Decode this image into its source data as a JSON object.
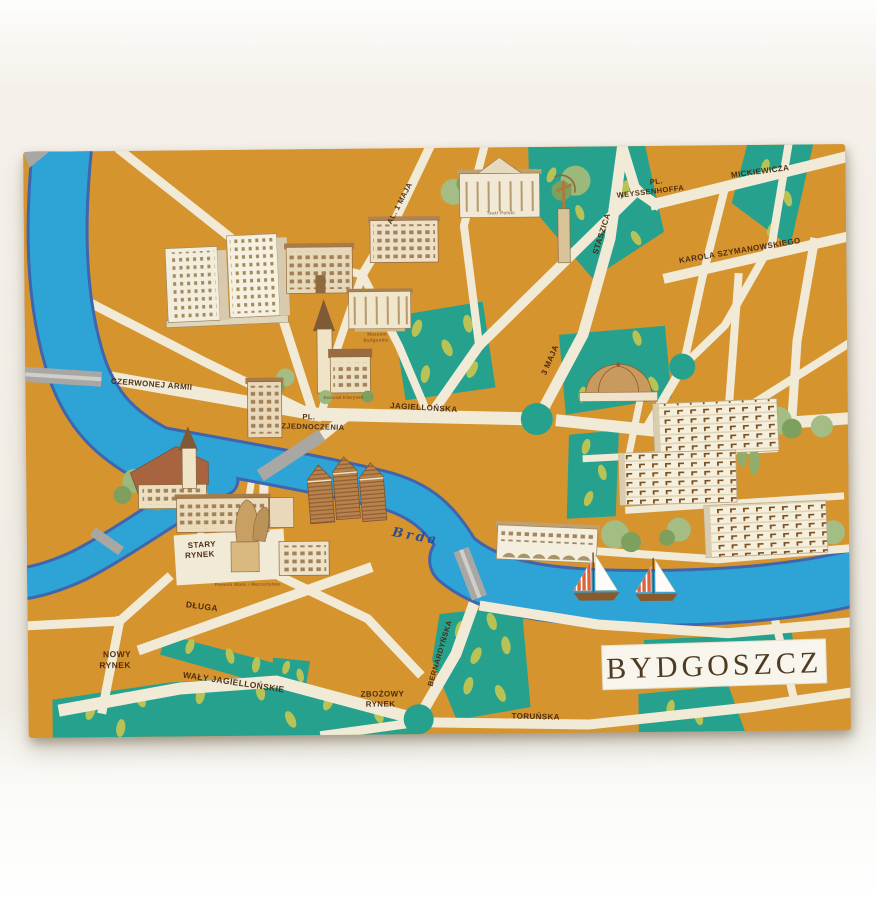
{
  "postcard": {
    "title": "BYDGOSZCZ",
    "river_label": "Brda",
    "labels": {
      "al_1_maja": "AL. 1 MAJA",
      "pl_weyssenhoffa_line1": "PL.",
      "pl_weyssenhoffa_line2": "WEYSSENHOFFA",
      "mickiewicza": "MICKIEWICZA",
      "karola_szymanowskiego": "KAROLA SZYMANOWSKIEGO",
      "staszica": "STASZICA",
      "trzeciego_maja": "3 MAJA",
      "czerwonej_armii": "CZERWONEJ ARMII",
      "jagiellonska": "JAGIELLOŃSKA",
      "pl_zjednoczenia_line1": "PL.",
      "pl_zjednoczenia_line2": "ZJEDNOCZENIA",
      "stary_rynek_line1": "STARY",
      "stary_rynek_line2": "RYNEK",
      "dluga": "DŁUGA",
      "nowy_rynek_line1": "NOWY",
      "nowy_rynek_line2": "RYNEK",
      "waly_jagiellonskie": "WAŁY JAGIELLOŃSKIE",
      "zbozowy_rynek_line1": "ZBOŻOWY",
      "zbozowy_rynek_line2": "RYNEK",
      "bernardynska": "BERNARDYŃSKA",
      "torunska": "TORUŃSKA"
    },
    "captions": {
      "teatr": "Teatr Polski",
      "muzeum_line1": "Muzeum",
      "muzeum_line2": "Bydgoskie",
      "kosciol": "Kościół Klarysek",
      "pomnik": "Pomnik Walki i Męczeństwa"
    },
    "features": [
      "Brda river with two sailboats",
      "high-rise hotel towers",
      "ornate tenement houses",
      "museum building",
      "theatre with columned portico",
      "Łuczniczka archer statue",
      "Clarisses church with spire",
      "parish church by the river bend",
      "old town houses on Stary Rynek",
      "gabled granaries",
      "martyrdom monument on the square",
      "arcaded riverside building",
      "modern apartment blocks with balconies",
      "domed hall",
      "parks with leaf symbols",
      "gray road bridges",
      "teal roundabouts"
    ],
    "colors": {
      "block_orange": "#d6942f",
      "street_cream": "#f1ead7",
      "river_blue": "#2da3d6",
      "river_outline": "#3f66ac",
      "park_teal": "#26a18d",
      "leaf_olive": "#b9c355",
      "bridge_gray": "#a8a7a3",
      "label_brown": "#46280e",
      "title_brown": "#4e3c22",
      "sail_stripe": "#e2622a"
    }
  }
}
